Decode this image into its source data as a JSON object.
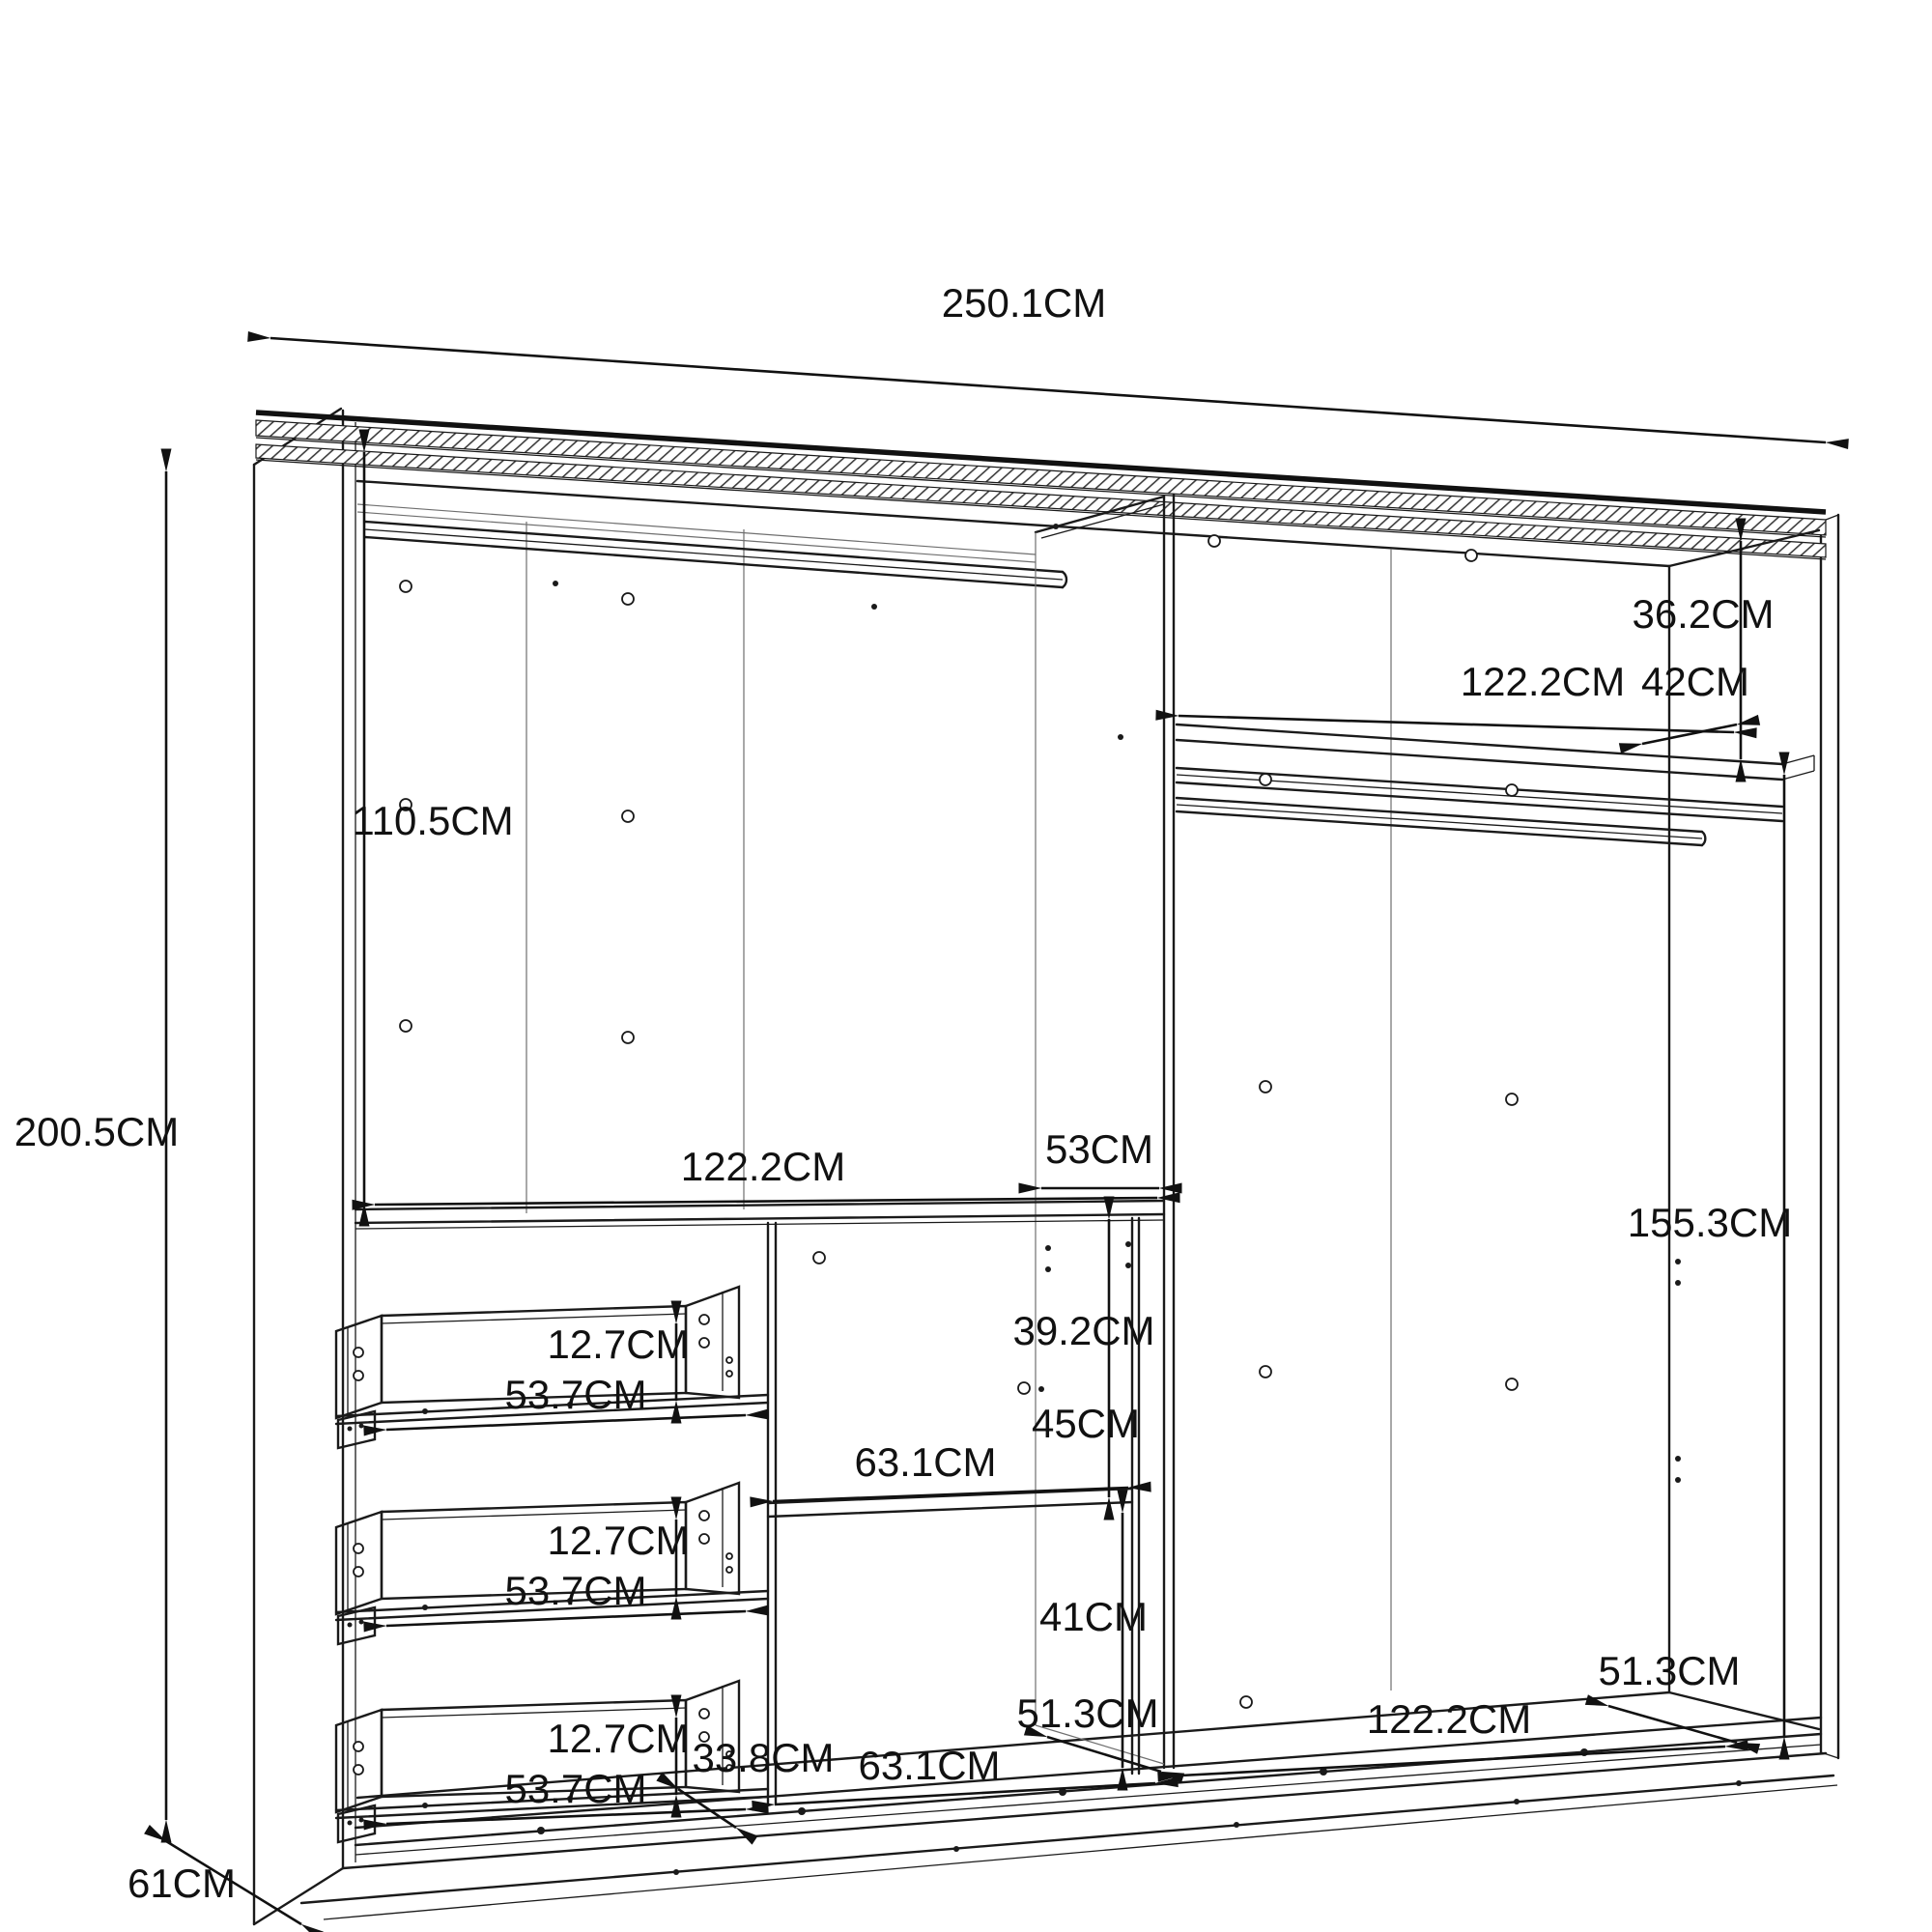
{
  "diagram": {
    "type": "wardrobe-interior-dimension-drawing",
    "units": "CM"
  },
  "dimensions": {
    "overall": {
      "width": "250.1CM",
      "height": "200.5CM",
      "depth": "61CM"
    },
    "left_section": {
      "hanging_height": "110.5CM",
      "width": "122.2CM"
    },
    "center_divider": {
      "depth": "53CM"
    },
    "middle_column": {
      "upper_height": "39.2CM",
      "shelf_gap_upper": "45CM",
      "shelf_width": "63.1CM",
      "shelf_gap_lower": "41CM",
      "depth": "51.3CM",
      "floor_width": "63.1CM",
      "side_depth": "33.8CM"
    },
    "right_section": {
      "top_shelf_offset": "36.2CM",
      "width_top": "122.2CM",
      "shelf_depth": "42CM",
      "hanging_height": "155.3CM",
      "floor_depth": "51.3CM",
      "width_bottom": "122.2CM"
    },
    "drawers": {
      "drawer1": {
        "height": "12.7CM",
        "width": "53.7CM"
      },
      "drawer2": {
        "height": "12.7CM",
        "width": "53.7CM"
      },
      "drawer3": {
        "height": "12.7CM",
        "width": "53.7CM"
      }
    }
  }
}
